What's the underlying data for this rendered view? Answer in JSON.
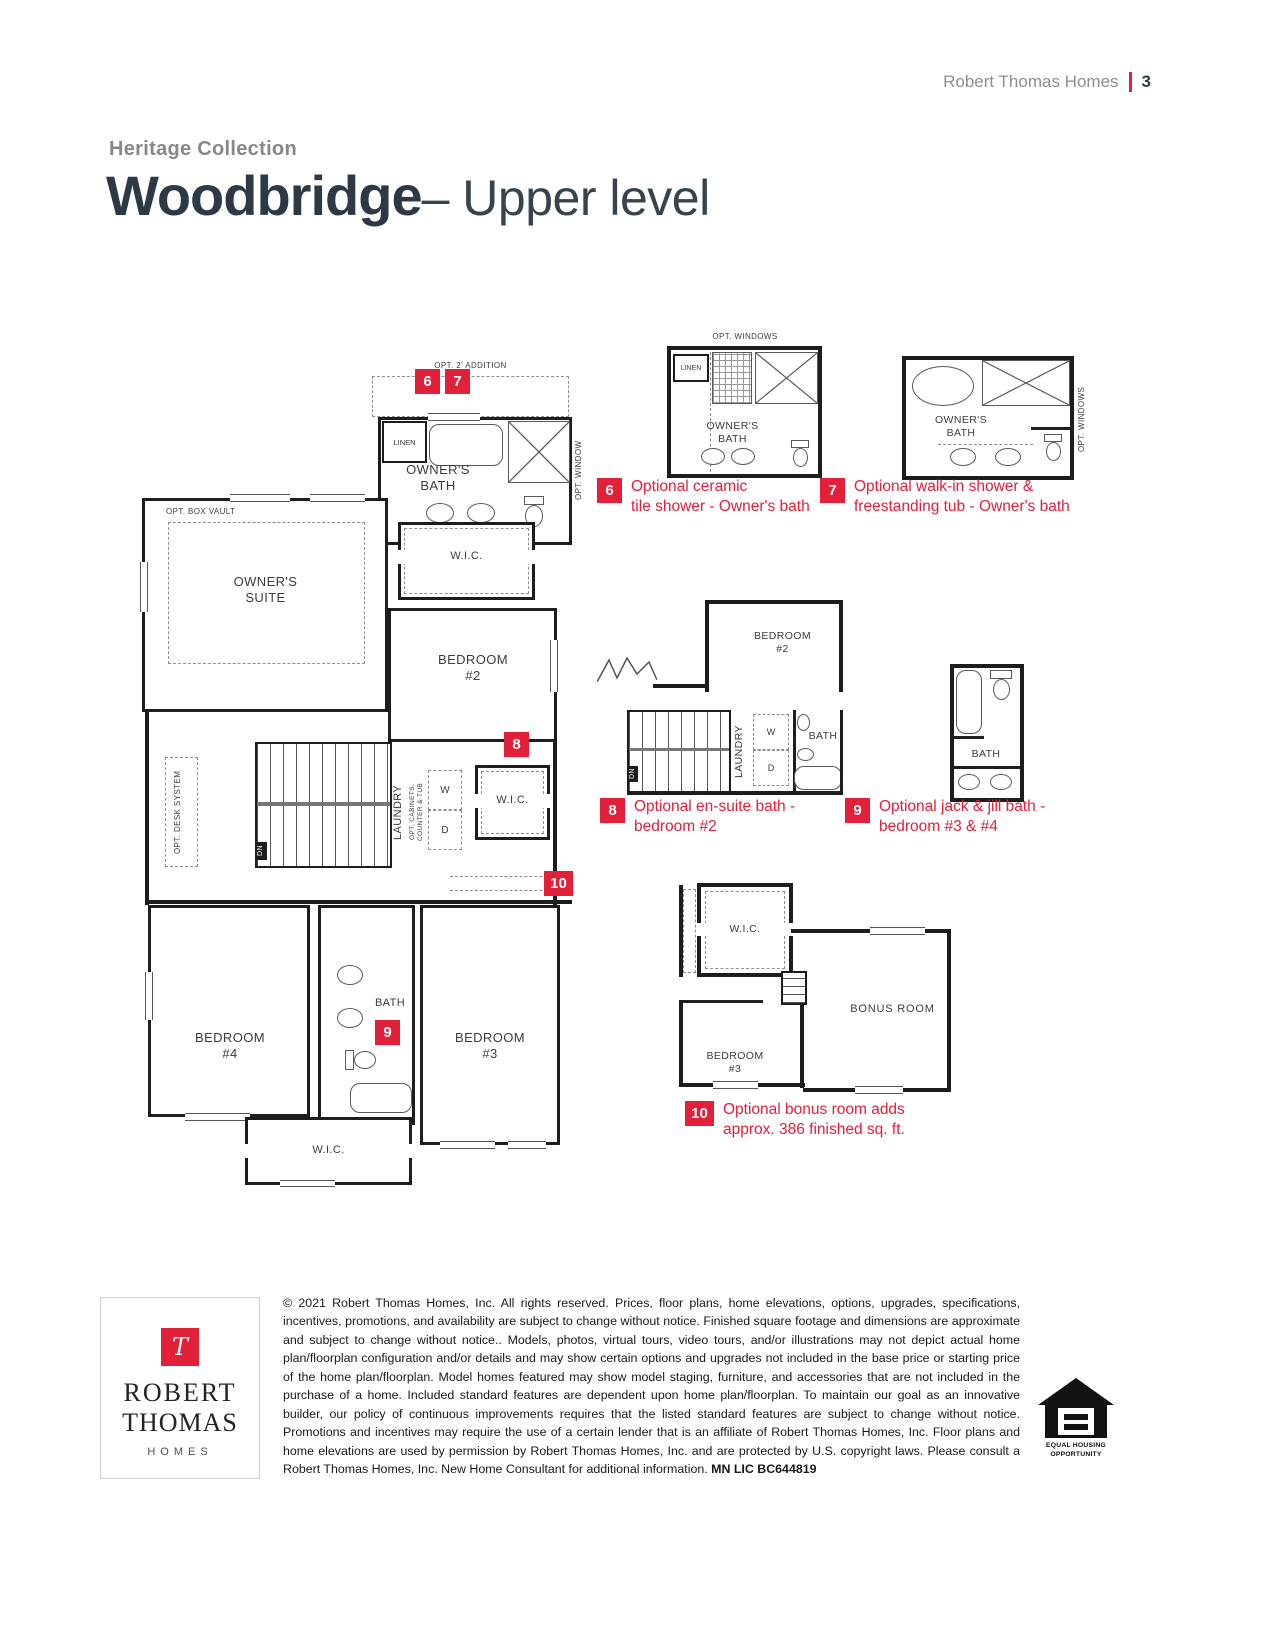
{
  "header": {
    "brand": "Robert Thomas Homes",
    "page": "3"
  },
  "title": {
    "collection": "Heritage Collection",
    "name": "Woodbridge",
    "suffix": "– Upper level"
  },
  "colors": {
    "accent": "#e2203a",
    "ink": "#2d3a45",
    "gray": "#85888b"
  },
  "plan": {
    "opt_addition": "OPT. 2' ADDITION",
    "linen": "LINEN",
    "owners_bath": "OWNER'S\nBATH",
    "opt_window": "OPT. WINDOW",
    "opt_windows": "OPT. WINDOWS",
    "opt_box_vault": "OPT. BOX VAULT",
    "owners_suite": "OWNER'S\nSUITE",
    "wic": "W.I.C.",
    "bedroom2": "BEDROOM\n#2",
    "bedroom3": "BEDROOM\n#3",
    "bedroom4": "BEDROOM\n#4",
    "opt_desk": "OPT. DESK SYSTEM",
    "laundry": "LAUNDRY",
    "opt_cabinets": "OPT. CABINETS,\nCOUNTER & TUB",
    "washer": "W",
    "dryer": "D",
    "dn": "DN",
    "bath": "BATH",
    "bonus_room": "BONUS ROOM"
  },
  "options": [
    {
      "num": "6",
      "text": "Optional ceramic\ntile shower - Owner's bath"
    },
    {
      "num": "7",
      "text": "Optional walk-in shower &\nfreestanding tub - Owner's bath"
    },
    {
      "num": "8",
      "text": "Optional en-suite bath -\nbedroom #2"
    },
    {
      "num": "9",
      "text": "Optional jack & jill bath -\nbedroom #3 & #4"
    },
    {
      "num": "10",
      "text": "Optional bonus room adds\napprox. 386 finished sq. ft."
    }
  ],
  "footer": {
    "logo": {
      "monogram": "T",
      "line1": "ROBERT",
      "line2": "THOMAS",
      "line3": "HOMES"
    },
    "legal": "© 2021 Robert Thomas Homes, Inc. All rights reserved. Prices, floor plans, home elevations, options, upgrades, specifications, incentives, promotions, and availability are subject to change without notice. Finished square footage and dimensions are approximate and subject to change without notice.. Models, photos, virtual tours, video tours, and/or illustrations may not depict actual home plan/floorplan configuration and/or details and may show certain options and upgrades not included in the base price or starting price of the home plan/floorplan. Model homes featured may show model staging, furniture, and accessories that are not included in the purchase of a home. Included standard features are dependent upon home plan/floorplan. To maintain our goal as an innovative builder, our policy of continuous improvements requires that the listed standard features are subject to change without notice. Promotions and incentives may require the use of a certain lender that is an affiliate of Robert Thomas Homes, Inc. Floor plans and home elevations are used by permission by Robert Thomas Homes, Inc. and are protected by U.S. copyright laws. Please consult a Robert Thomas Homes, Inc. New Home Consultant for additional information.",
    "license": "MN LIC BC644819",
    "equal_housing": "EQUAL HOUSING\nOPPORTUNITY"
  }
}
